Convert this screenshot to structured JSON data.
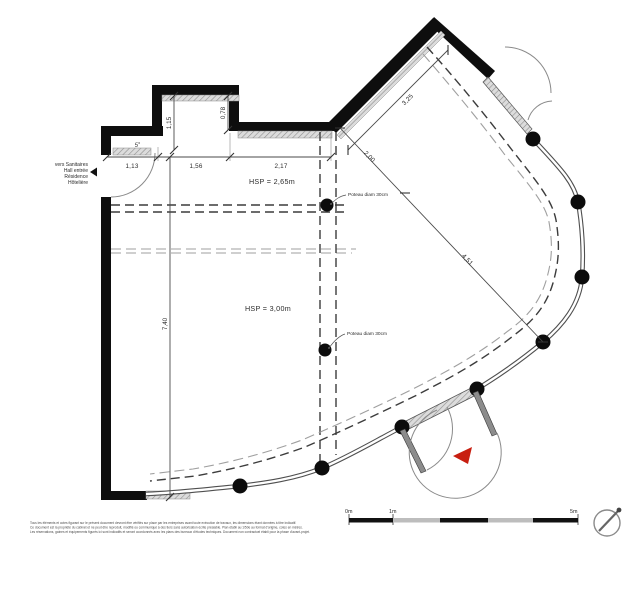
{
  "drawing": {
    "notes": {
      "left_note_lines": [
        "vers Sanitaires",
        "Hall entrée",
        "Résidence",
        "Hôtelière"
      ],
      "door_slope": "5°",
      "hsp_upper": "HSP = 2,65m",
      "hsp_main": "HSP = 3,00m",
      "poteau_upper": "Poteau diam 30cm",
      "poteau_lower": "Poteau diam 30cm"
    },
    "dimensions": {
      "top_1": "1,13",
      "top_2": "1,56",
      "top_3": "2,17",
      "recess_height": "1,15",
      "step_height": "0,78",
      "left_height": "7,40",
      "diag_inner_1": "2,00",
      "diag_inner_2": "4,51",
      "diag_wall": "3,25"
    },
    "scale_bar": {
      "label_0": "0m",
      "label_1": "1m",
      "label_5": "5m"
    },
    "disclaimer_lines": [
      "Tous les éléments et cotes figurant sur le présent document devront être vérifiés sur place par les entreprises avant toute exécution de travaux, les dimensions étant données à titre indicatif.",
      "Ce document est la propriété du cabinet et ne peut être reproduit, modifié ou communiqué à des tiers sans autorisation écrite préalable. Plan établi au 1/50e au format d'origine, cotes en mètres.",
      "Les réservations, gaines et équipements figurés ici sont indicatifs et seront coordonnés avec les plans des bureaux d'études techniques. Document non contractuel établi pour la phase d'avant-projet."
    ],
    "colors": {
      "wall": "#0e0e0e",
      "glazing": "#4f4f4f",
      "hatch": "#8f8f8f",
      "accent_red": "#c81e10",
      "dash_dark": "#3c3c3c",
      "dash_light": "#9f9f9f"
    }
  }
}
